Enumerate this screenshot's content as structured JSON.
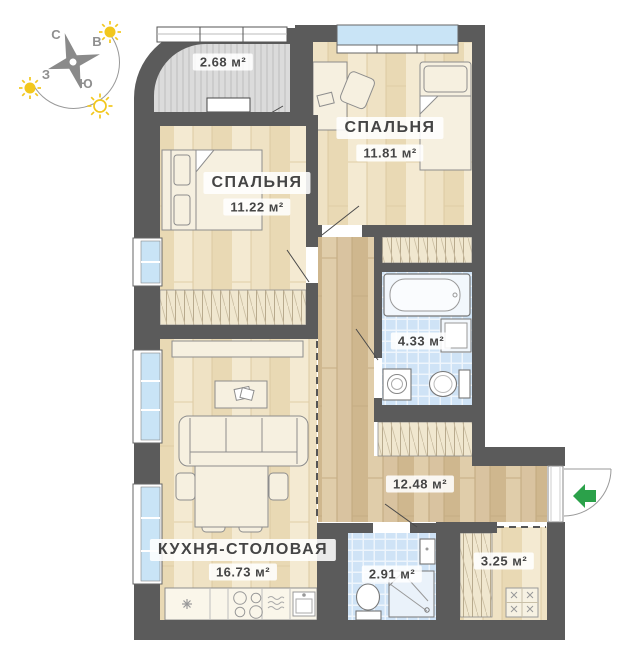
{
  "title": "Апартаменты — план этажа",
  "compass": {
    "n": "С",
    "e": "В",
    "s": "Ю",
    "w": "З"
  },
  "rooms": {
    "balcony": {
      "area": "2.68 м²"
    },
    "bedroom_top": {
      "name": "СПАЛЬНЯ",
      "area": "11.81 м²"
    },
    "bedroom_left": {
      "name": "СПАЛЬНЯ",
      "area": "11.22 м²"
    },
    "bathroom": {
      "area": "4.33 м²"
    },
    "corridor": {
      "area": "12.48 м²"
    },
    "kitchen": {
      "name": "КУХНЯ-СТОЛОВАЯ",
      "area": "16.73 м²"
    },
    "wc": {
      "area": "2.91 м²"
    },
    "storage": {
      "area": "3.25 м²"
    }
  },
  "colors": {
    "wall": "#5b5b5b",
    "wood_light": "#efe2c4",
    "wood_dark": "#d9c3a0",
    "tile": "#cfe3f6",
    "window_glass": "#c9e4f6",
    "balcony_floor": "#dbdbdb",
    "furniture": "#f6f0e0",
    "accent_arrow": "#2ba14a",
    "sun": "#f2c71d",
    "label_text": "#454545"
  }
}
